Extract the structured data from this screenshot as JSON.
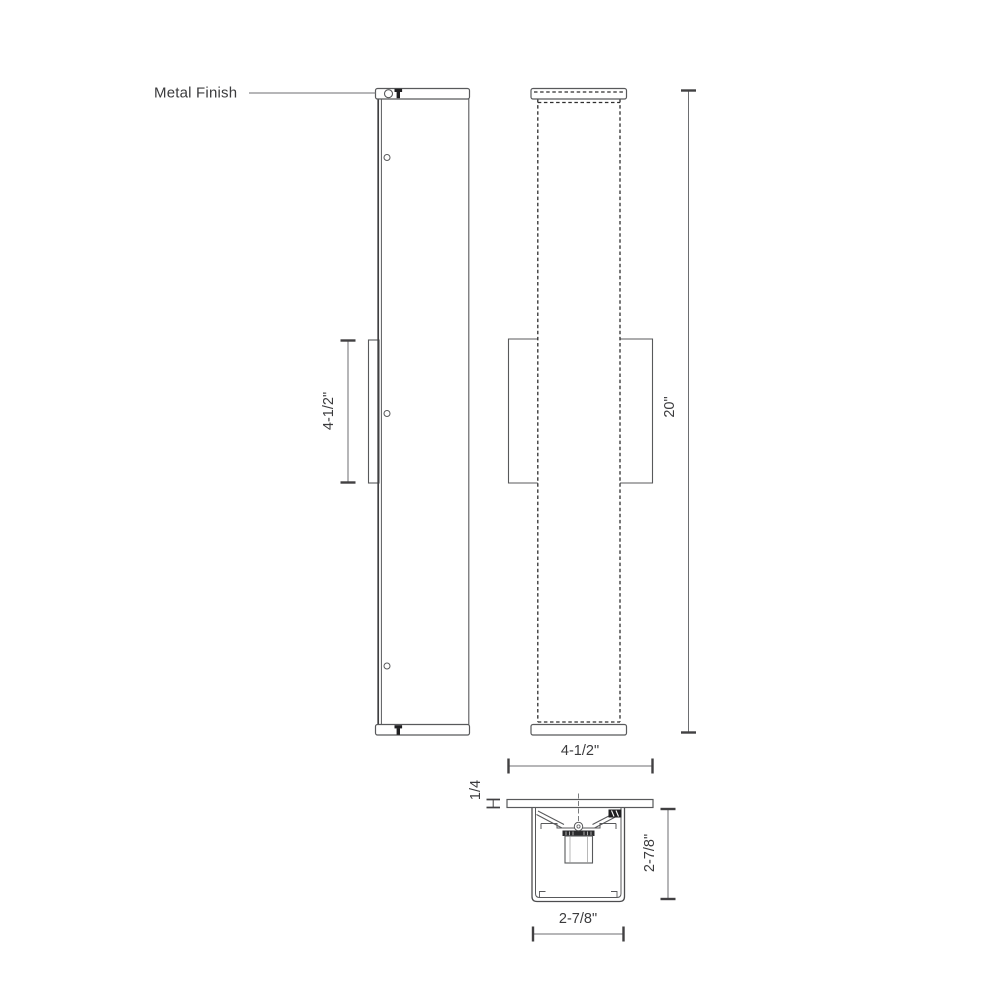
{
  "callout": {
    "metal_finish": "Metal Finish"
  },
  "dimensions": {
    "backplate_height": "4-1/2\"",
    "overall_height": "20\"",
    "overall_width": "4-1/2\"",
    "canopy_thickness": "1/4",
    "section_depth": "2-7/8\"",
    "section_width": "2-7/8\""
  },
  "colors": {
    "background": "#ffffff",
    "outline": "#58595b",
    "hidden_line": "#2e2e2e",
    "dimension_line": "#6d6e71",
    "tick": "#414042",
    "text": "#3b3b3d",
    "dark_fill": "#1f1f21"
  }
}
